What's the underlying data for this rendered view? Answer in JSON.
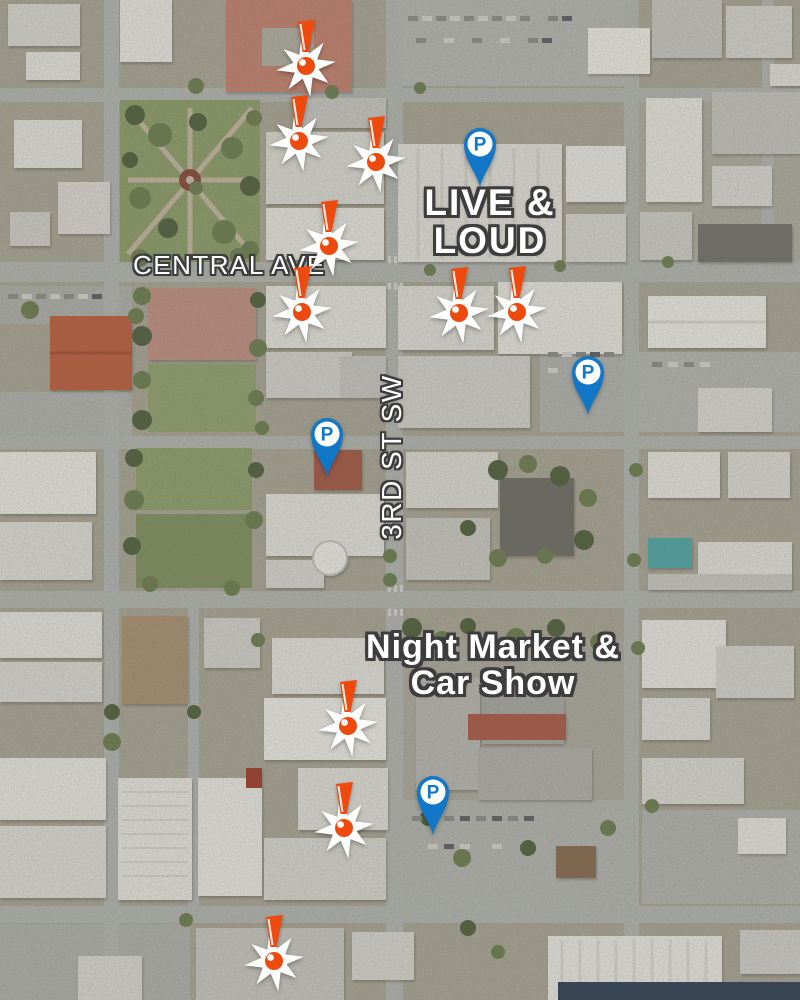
{
  "map": {
    "view": "satellite-aerial",
    "street_labels": [
      {
        "id": "central-ave",
        "text": "CENTRAL AVE",
        "orientation": "horizontal"
      },
      {
        "id": "3rd-st-sw",
        "text": "3RD ST SW",
        "orientation": "vertical"
      }
    ],
    "event_labels": [
      {
        "id": "live-and-loud",
        "line1": "LIVE &",
        "line2": "LOUD"
      },
      {
        "id": "night-market-car-show",
        "line1": "Night Market &",
        "line2": "Car Show"
      }
    ],
    "markers": {
      "alert": {
        "icon": "exclamation-burst-icon",
        "count": 10,
        "positions": [
          [
            306,
            66
          ],
          [
            299,
            141
          ],
          [
            376,
            162
          ],
          [
            329,
            246
          ],
          [
            302,
            312
          ],
          [
            459,
            313
          ],
          [
            517,
            312
          ],
          [
            348,
            726
          ],
          [
            344,
            828
          ],
          [
            274,
            961
          ]
        ]
      },
      "parking": {
        "icon": "parking-pin-icon",
        "letter": "P",
        "count": 4,
        "positions": [
          [
            480,
            187
          ],
          [
            588,
            415
          ],
          [
            327,
            477
          ],
          [
            433,
            835
          ]
        ]
      }
    },
    "colors": {
      "parking_blue": "#1277c7",
      "alert_orange": "#ee4a0d",
      "burst_white": "#ffffff",
      "label_text": "#ffffff",
      "label_outline": "#3d3d3d"
    }
  }
}
